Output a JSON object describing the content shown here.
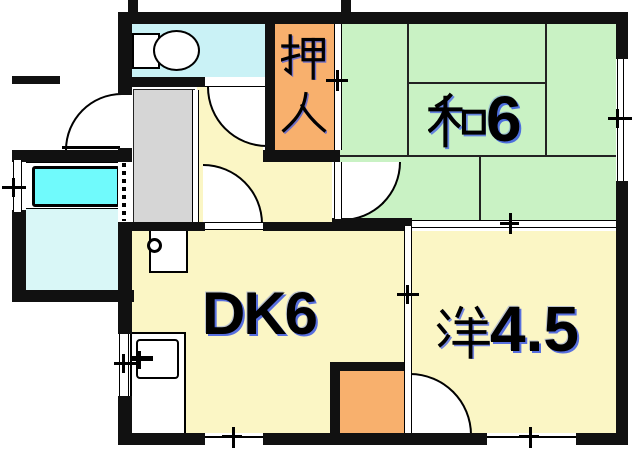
{
  "plan": {
    "kind": "apartment-floorplan",
    "rooms": {
      "washitsu": {
        "label": "和6",
        "kanji": "和",
        "number": "6"
      },
      "dining_kitchen": {
        "label": "DK6"
      },
      "western_room": {
        "label": "洋4.5",
        "kanji": "洋",
        "number": "4.5"
      },
      "oshiire": {
        "label": "押入",
        "kanji_chars": [
          "押",
          "入"
        ]
      }
    },
    "fixtures": [
      "toilet",
      "bathtub",
      "kitchen-sink",
      "water-heater",
      "accordion-door"
    ],
    "colors": {
      "tatami_green": "#c9f2c4",
      "floor_yellow": "#fbf6c5",
      "closet_orange": "#f8b06d",
      "toilet_cyan": "#caf2f6",
      "bath_floor": "#d9f7f7",
      "bathtub_cyan": "#70fafc",
      "entry_gray": "#d6d6d6",
      "wall_black": "#111111",
      "label_blue": "#3a55e8"
    }
  }
}
